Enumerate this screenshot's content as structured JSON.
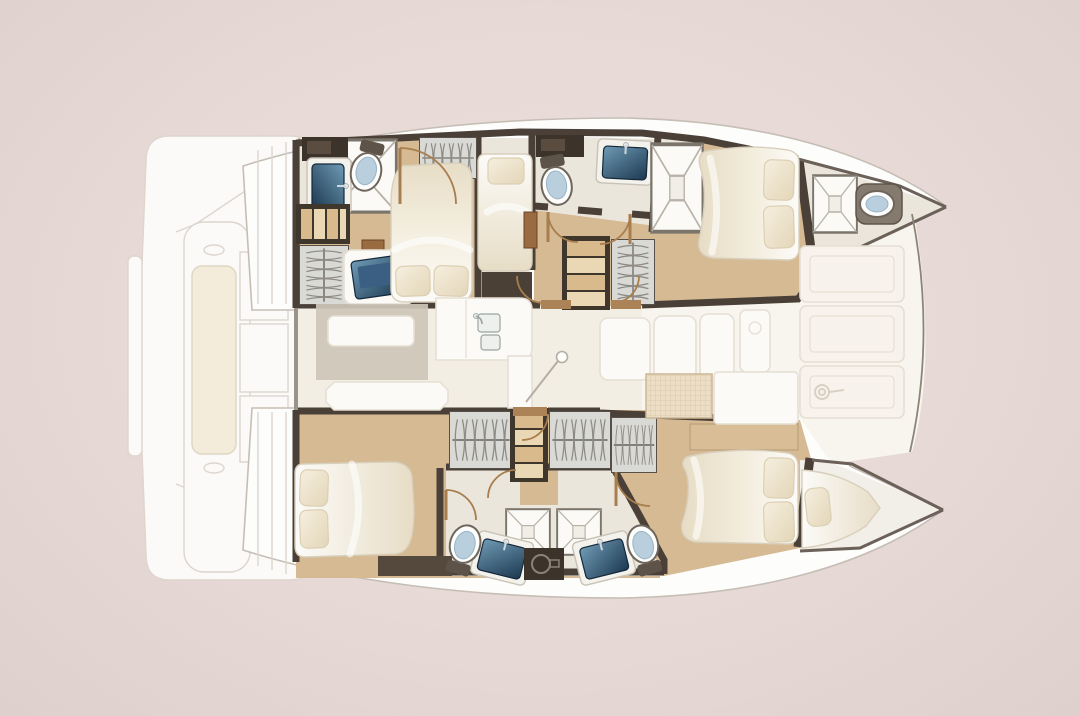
{
  "meta": {
    "title": "Catamaran yacht deck plan — top-down interior floor plan, bow to the right",
    "description": "Illustrated accommodation layout of a sailing catamaran: two hulls with cabins and bathrooms, central saloon with galley and dining table, forward cockpit with trampoline net, foredeck and aft platform."
  },
  "vessel": {
    "type": "catamaran",
    "view": "top-down deck plan",
    "orientation": "bow-right"
  },
  "hulls": {
    "starboard_hull_top": {
      "rooms": [
        {
          "name": "aft cabin",
          "fixtures": [
            "double-bed",
            "pillows",
            "wardrobe",
            "vanity-desk",
            "tv-screen",
            "nightstand",
            "steps"
          ]
        },
        {
          "name": "aft bathroom",
          "fixtures": [
            "washbasin",
            "toilet",
            "shower-floor",
            "vanity-cabinet",
            "door"
          ]
        },
        {
          "name": "single berth cabin",
          "fixtures": [
            "single-bed",
            "pillow",
            "cabinet"
          ]
        },
        {
          "name": "mid bathroom",
          "fixtures": [
            "toilet",
            "washbasin",
            "shower-cubicle",
            "vanity-cabinet"
          ]
        },
        {
          "name": "corridor",
          "fixtures": [
            "staircase",
            "wardrobe",
            "doors"
          ]
        },
        {
          "name": "forward cabin",
          "fixtures": [
            "double-bed",
            "pillows"
          ]
        },
        {
          "name": "forepeak head",
          "fixtures": [
            "shower-pan",
            "toilet"
          ]
        }
      ]
    },
    "port_hull_bottom": {
      "rooms": [
        {
          "name": "aft cabin",
          "fixtures": [
            "double-bed",
            "pillows",
            "bench",
            "door"
          ]
        },
        {
          "name": "twin bathrooms",
          "fixtures": [
            "shower-cubicle",
            "shower-cubicle",
            "toilet",
            "toilet",
            "washbasin",
            "washbasin",
            "utility-unit"
          ]
        },
        {
          "name": "corridor",
          "fixtures": [
            "staircase",
            "wardrobes",
            "doors"
          ]
        },
        {
          "name": "forward cabin",
          "fixtures": [
            "double-bed",
            "pillows",
            "sideboard",
            "wardrobe"
          ]
        },
        {
          "name": "forepeak berth",
          "fixtures": [
            "single-berth",
            "pillow"
          ]
        }
      ]
    }
  },
  "bridge_deck": {
    "saloon": {
      "fixtures": [
        "dining-table",
        "sofa-bench",
        "galley-counter",
        "galley-sink",
        "mast-post"
      ]
    },
    "forward_cockpit": {
      "fixtures": [
        "lounge-seats",
        "table",
        "trampoline-net",
        "deck-area"
      ]
    },
    "foredeck": {
      "fixtures": [
        "deck-panels",
        "windlass",
        "bow-beam"
      ]
    }
  },
  "aft_platform": {
    "fixtures": [
      "swim-platform",
      "transom-bench",
      "bench-cushion",
      "deck-panels",
      "davit-wings"
    ]
  },
  "colors": {
    "bg": "#e7d9d5",
    "bg-light": "#ece0dc",
    "bg-dark": "#ded0cc",
    "hull": "#fdfdfc",
    "hull-stroke": "#c6beb5",
    "deck-faint": "#fbfaf9",
    "deck-stroke": "#ddd5ce",
    "saloon-floor": "#f3eee4",
    "cockpit-floor": "#f8f5ef",
    "foredeck": "#f7f3ec",
    "panel-stroke": "#e6dfd3",
    "wood": "#d5ba94",
    "bath-floor": "#eae6dc",
    "wall": "#4a4037",
    "wall-thin": "#6b6158",
    "wardrobe": "#d9d9d6",
    "white-furniture": "#fbfaf7",
    "table-base": "#cdc5b8",
    "toilet-seat": "#b9cfdd",
    "toilet-rim": "#6e665c",
    "door": "#a87e4e",
    "threshold": "#ab8356",
    "wood-cabinet": "#9a6a40",
    "dark-cabinet": "#3c332b",
    "beam": "#8d8478"
  }
}
